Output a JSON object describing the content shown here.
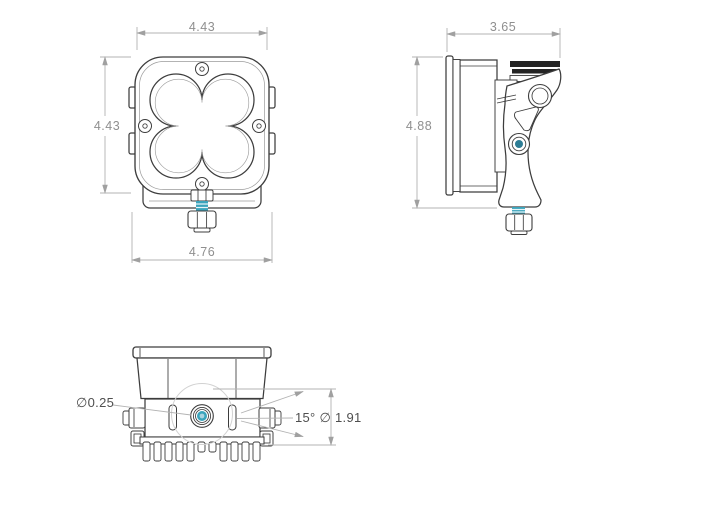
{
  "colors": {
    "line": "#3d3d3d",
    "line_light": "#9b9b9b",
    "dim_line": "#b3b3b3",
    "dim_text": "#8f8f8f",
    "callout_text": "#4f4f4f",
    "accent_teal": "#3ba4bc",
    "accent_teal_dark": "#2d7d95",
    "accent_teal_light": "#a8d4e0",
    "fin_dark": "#242424",
    "reference_faint": "#d2d2d2",
    "background": "#ffffff"
  },
  "views": {
    "front": {
      "dim_width_top": "4.43",
      "dim_height_left": "4.43",
      "dim_overall_width_bottom": "4.76"
    },
    "side": {
      "dim_depth_top": "3.65",
      "dim_height_left": "4.88"
    },
    "bottom": {
      "callout_hole_diameter": "∅0.25",
      "callout_angle_bolt_circle": "15° ∅ 1.91"
    }
  }
}
